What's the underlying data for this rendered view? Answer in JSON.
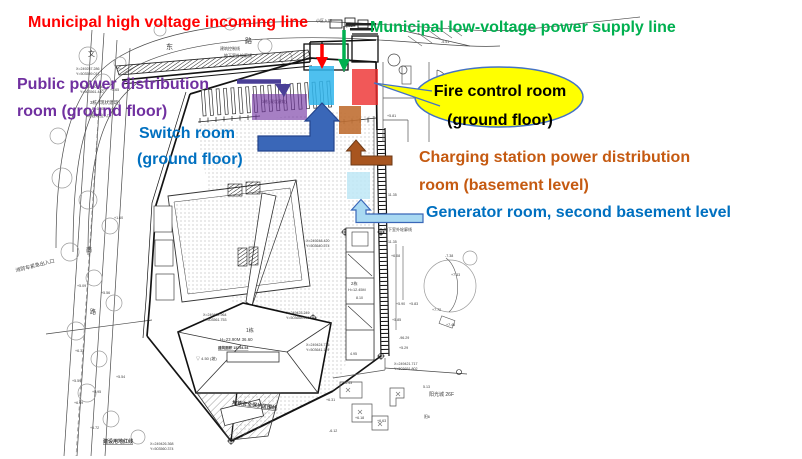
{
  "colors": {
    "label-red": "#FF0000",
    "label-green": "#00B050",
    "label-purple": "#7030A0",
    "label-blue": "#0070C0",
    "label-brown": "#C55A11",
    "callout-fill": "#FFFF00",
    "callout-stroke": "#4472C4",
    "hl-purple": "#7030A0",
    "hl-cyan": "#2FB5EC",
    "hl-red": "#EE2E2E",
    "hl-brown": "#C06F33",
    "hl-pale": "#BEE7F6",
    "arrow-blue": "#3A67B8",
    "arrow-blue-stroke": "#24448C",
    "arrow-brown": "#A8551F",
    "arrow-brown-stroke": "#6E3A17",
    "arrow-pale": "#A9D9F2",
    "arrow-pale-stroke": "#3A67B8",
    "arrow-violet": "#4A3F97",
    "arrow-red": "#FF0000",
    "arrow-green": "#00B050"
  },
  "annotations": {
    "high_voltage": "Municipal high voltage incoming line",
    "low_voltage": "Municipal low-voltage power supply line",
    "public_power_l1": "Public power distribution",
    "public_power_l2": "room (ground floor)",
    "switch_l1": "Switch room",
    "switch_l2": "(ground floor)",
    "fire_l1": "Fire control room",
    "fire_l2": "(ground floor)",
    "charging_l1": "Charging station power distribution",
    "charging_l2": "room (basement level)",
    "generator": "Generator room, second basement level"
  },
  "cad": {
    "texts": [
      {
        "t": "文",
        "x": 88,
        "y": 56,
        "s": 7
      },
      {
        "t": "东",
        "x": 166,
        "y": 49,
        "s": 7
      },
      {
        "t": "路",
        "x": 245,
        "y": 43,
        "s": 7
      },
      {
        "t": "南",
        "x": 86,
        "y": 252,
        "s": 6
      },
      {
        "t": "路",
        "x": 90,
        "y": 314,
        "s": 6
      },
      {
        "t": "消防车紧急出入口",
        "x": 16,
        "y": 272,
        "s": 5,
        "r": -14
      },
      {
        "t": "建设用地红线",
        "x": 103,
        "y": 443,
        "s": 5,
        "u": 1,
        "b": 1
      },
      {
        "t": "地铁安全保护区围线",
        "x": 232,
        "y": 404,
        "s": 5,
        "r": 7,
        "u": 1,
        "b": 1
      },
      {
        "t": "建筑控制线",
        "x": 220,
        "y": 50,
        "s": 4
      },
      {
        "t": "地下室外轮廓线",
        "x": 224,
        "y": 57,
        "s": 4
      },
      {
        "t": "地下室外轮廓线",
        "x": 384,
        "y": 231,
        "s": 4
      },
      {
        "t": "小区入口",
        "x": 316,
        "y": 22,
        "s": 4
      },
      {
        "t": "QS1",
        "x": 345,
        "y": 27,
        "s": 3.8
      },
      {
        "t": "3栋 (现状建筑)",
        "x": 90,
        "y": 104,
        "s": 4.6
      },
      {
        "t": "B=0.05M  6.00",
        "x": 92,
        "y": 110,
        "s": 3.8
      },
      {
        "t": "3栋建筑出入口",
        "x": 86,
        "y": 117,
        "s": 3.8
      },
      {
        "t": "3栋 (现状建筑)",
        "x": 262,
        "y": 103,
        "s": 3.8
      },
      {
        "t": "X=249257.286",
        "x": 76,
        "y": 70,
        "s": 3.6
      },
      {
        "t": "Y=503559.017",
        "x": 76,
        "y": 75,
        "s": 3.6
      },
      {
        "t": "X=249260.130",
        "x": 80,
        "y": 88,
        "s": 3.6
      },
      {
        "t": "Y=503561.440",
        "x": 80,
        "y": 93,
        "s": 3.6
      },
      {
        "t": "X=249248.420",
        "x": 306,
        "y": 242,
        "s": 3.6
      },
      {
        "t": "Y=503640.574",
        "x": 306,
        "y": 247,
        "s": 3.6
      },
      {
        "t": "X=249422.964",
        "x": 203,
        "y": 316,
        "s": 3.6
      },
      {
        "t": "Y=503561.753",
        "x": 203,
        "y": 321,
        "s": 3.6
      },
      {
        "t": "X=249423.249",
        "x": 286,
        "y": 314,
        "s": 3.6
      },
      {
        "t": "Y=503658.430",
        "x": 286,
        "y": 319,
        "s": 3.6
      },
      {
        "t": "X=249424.725",
        "x": 306,
        "y": 346,
        "s": 3.6
      },
      {
        "t": "Y=503641.119",
        "x": 306,
        "y": 351,
        "s": 3.6
      },
      {
        "t": "X=249421.717",
        "x": 394,
        "y": 365,
        "s": 3.6
      },
      {
        "t": "Y=503651.802",
        "x": 394,
        "y": 370,
        "s": 3.6
      },
      {
        "t": "X=249426.368",
        "x": 150,
        "y": 445,
        "s": 3.6
      },
      {
        "t": "Y=503560.374",
        "x": 150,
        "y": 450,
        "s": 3.6
      },
      {
        "t": "1栋",
        "x": 246,
        "y": 332,
        "s": 5
      },
      {
        "t": "H=23.90M  36.60",
        "x": 220,
        "y": 341,
        "s": 4.4
      },
      {
        "t": "建筑面积 15754.54",
        "x": 218,
        "y": 349,
        "s": 3.6,
        "b": 1,
        "u": 1
      },
      {
        "t": "▽ 4.50 (坡)",
        "x": 196,
        "y": 360,
        "s": 4
      },
      {
        "t": "2栋",
        "x": 351,
        "y": 285,
        "s": 4.2
      },
      {
        "t": "H=12.45M",
        "x": 348,
        "y": 291,
        "s": 3.8
      },
      {
        "t": "8.10",
        "x": 356,
        "y": 299,
        "s": 3.6
      },
      {
        "t": "4.95",
        "x": 350,
        "y": 355,
        "s": 3.6
      },
      {
        "t": "阳光城  26F",
        "x": 429,
        "y": 396,
        "s": 5
      },
      {
        "t": "阳6",
        "x": 424,
        "y": 418,
        "s": 3.8
      },
      {
        "t": "+5.65",
        "x": 110,
        "y": 91,
        "s": 3.6
      },
      {
        "t": "+1.60",
        "x": 114,
        "y": 219,
        "s": 3.6
      },
      {
        "t": "+5.09",
        "x": 77,
        "y": 287,
        "s": 3.6
      },
      {
        "t": "+5.56",
        "x": 101,
        "y": 294,
        "s": 3.6
      },
      {
        "t": "+6.37",
        "x": 75,
        "y": 352,
        "s": 3.6
      },
      {
        "t": "+5.59",
        "x": 72,
        "y": 382,
        "s": 3.6
      },
      {
        "t": "+5.95",
        "x": 92,
        "y": 393,
        "s": 3.6
      },
      {
        "t": "+6.49",
        "x": 74,
        "y": 404,
        "s": 3.6
      },
      {
        "t": "+5.72",
        "x": 90,
        "y": 429,
        "s": 3.6
      },
      {
        "t": "+5.54",
        "x": 116,
        "y": 378,
        "s": 3.6
      },
      {
        "t": "-5.51",
        "x": 441,
        "y": 43,
        "s": 3.6
      },
      {
        "t": "+5.81",
        "x": 387,
        "y": 117,
        "s": 3.6
      },
      {
        "t": "11.35",
        "x": 388,
        "y": 196,
        "s": 3.6
      },
      {
        "t": "11.35",
        "x": 388,
        "y": 243,
        "s": 3.6
      },
      {
        "t": "+6.08",
        "x": 391,
        "y": 257,
        "s": 3.6
      },
      {
        "t": "-7.38",
        "x": 445,
        "y": 257,
        "s": 3.6
      },
      {
        "t": "+7.33",
        "x": 451,
        "y": 276,
        "s": 3.6
      },
      {
        "t": "+5.90",
        "x": 396,
        "y": 305,
        "s": 3.6
      },
      {
        "t": "+5.83",
        "x": 409,
        "y": 305,
        "s": 3.6
      },
      {
        "t": "+7.72",
        "x": 432,
        "y": 311,
        "s": 3.6
      },
      {
        "t": "+5.85",
        "x": 392,
        "y": 321,
        "s": 3.6
      },
      {
        "t": "+7.48",
        "x": 446,
        "y": 326,
        "s": 3.6
      },
      {
        "t": "-96.29",
        "x": 399,
        "y": 339,
        "s": 3.6
      },
      {
        "t": "+5.29",
        "x": 399,
        "y": 349,
        "s": 3.6
      },
      {
        "t": "+6.43",
        "x": 343,
        "y": 384,
        "s": 3.6
      },
      {
        "t": "5.13",
        "x": 423,
        "y": 388,
        "s": 3.6
      },
      {
        "t": "+6.31",
        "x": 326,
        "y": 401,
        "s": 3.6
      },
      {
        "t": "+6.18",
        "x": 355,
        "y": 419,
        "s": 3.6
      },
      {
        "t": "-6.12",
        "x": 329,
        "y": 432,
        "s": 3.6
      },
      {
        "t": "+6.63",
        "x": 377,
        "y": 422,
        "s": 3.6
      }
    ]
  }
}
